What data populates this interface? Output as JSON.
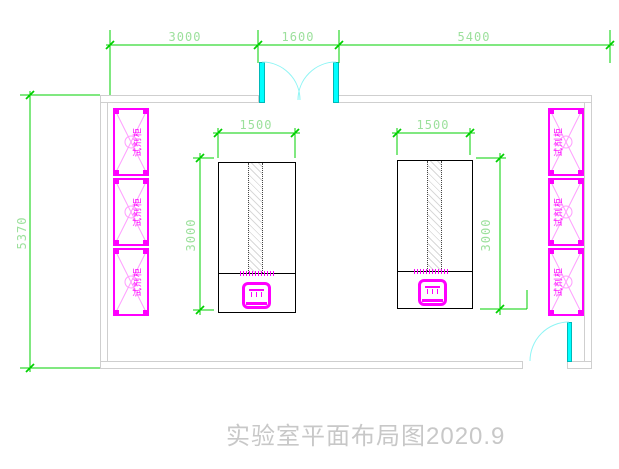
{
  "title": "实验室平面布局图2020.9",
  "room": {
    "dim_top_left": "3000",
    "dim_top_middle": "1600",
    "dim_top_right": "5400",
    "dim_left_height": "5370"
  },
  "benches": {
    "left": {
      "width_label": "1500",
      "depth_label": "3000"
    },
    "right": {
      "width_label": "1500",
      "depth_label": "3000"
    }
  },
  "cabinets": {
    "label": "试剂柜"
  },
  "colors": {
    "dimension_line": "#00d000",
    "dimension_text": "#9ce09c",
    "cabinet": "#ff00ff",
    "cabinet_hatch": "#ff9dff",
    "door": "#00ffff",
    "door_arc": "#8ef5f5",
    "wall": "#cfcfcf",
    "bench_outline": "#000000",
    "title_text": "#c8c8c8"
  }
}
